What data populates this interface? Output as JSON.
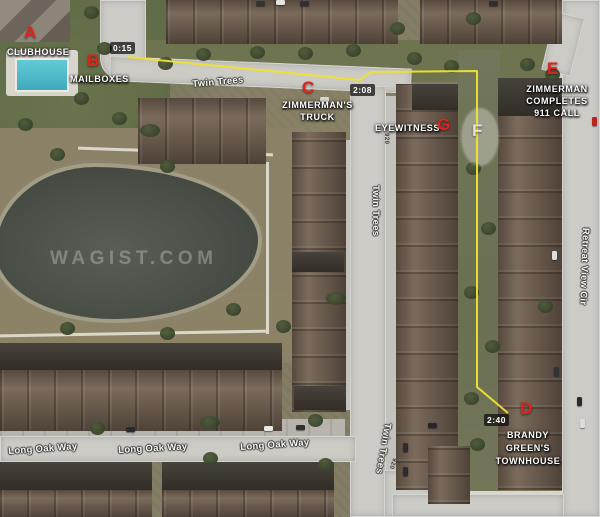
{
  "watermark": "WAGIST.COM",
  "colors": {
    "marker_red": "#e2211a",
    "route_yellow": "#f0e12e",
    "label_white": "#ffffff",
    "highlight_ellipse": "rgba(255,255,255,0.32)",
    "pool_teal": "#54bccb"
  },
  "markers": {
    "a": {
      "letter": "A",
      "label": "CLUBHOUSE"
    },
    "b": {
      "letter": "B",
      "label": "MAILBOXES",
      "time": "0:15"
    },
    "c": {
      "letter": "C",
      "time": "2:08",
      "label_line1": "ZIMMERMAN'S",
      "label_line2": "TRUCK"
    },
    "d": {
      "letter": "D",
      "time": "2:40",
      "label_line1": "BRANDY GREEN'S",
      "label_line2": "TOWNHOUSE"
    },
    "e": {
      "letter": "E",
      "label_line1": "ZIMMERMAN",
      "label_line2": "COMPLETES",
      "label_line3": "911 CALL"
    },
    "f": {
      "letter": "F"
    },
    "g": {
      "letter": "G",
      "label": "EYEWITNESS"
    }
  },
  "streets": {
    "twin_trees": "Twin Trees",
    "long_oak_way": "Long Oak Way",
    "retreat_view_cir": "Retreat View Cir",
    "address_920": "920"
  }
}
